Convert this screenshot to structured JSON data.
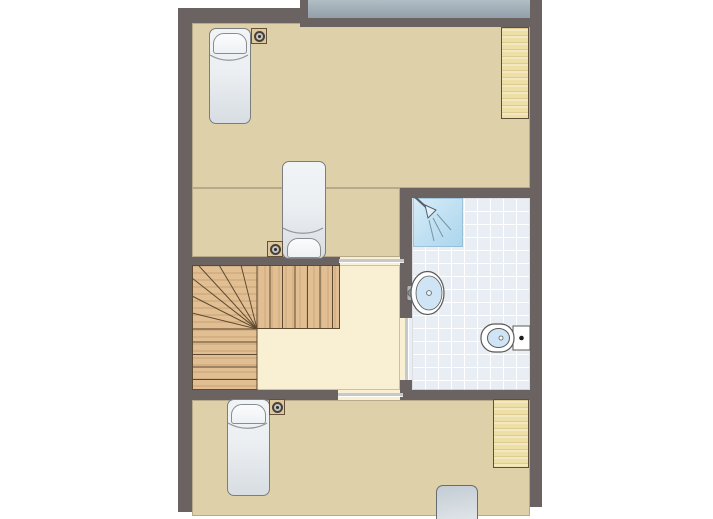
{
  "title": "Floor plan",
  "colors": {
    "wall": "#6b6361",
    "floor-tan": "#ded0a9",
    "floor-cream": "#f9efd3",
    "tile-bg": "#e9edf4",
    "tile-line": "#ffffff",
    "roof-top": "#b2bec6",
    "roof-bottom": "#939fa9",
    "door": "#c6c9cb",
    "wood-stairs": "#e2bf93",
    "stair-line": "#5e4a31",
    "wood-desk": "#eedfa6",
    "desk-line": "#5f5038",
    "bed-top": "#f1f4f6",
    "bed-bottom": "#d7dde2",
    "bed-outline": "#7b7d7f",
    "pillow": "#fbfcfd",
    "bed4-top": "#c3ccd4",
    "bed4-bottom": "#e0e5e9",
    "nightstand": "#dfc99c",
    "nightstand-outline": "#63513a",
    "lamp-ring": "#45413c",
    "shower-top": "#d6ecf8",
    "shower-bottom": "#aad5ec",
    "fixture-outline": "#5a5a58",
    "basin": "#cfe4f4",
    "toilet-dot": "#1c1c1c"
  },
  "plan": {
    "rooms": [
      {
        "id": "bedroom-top",
        "kind": "bedroom"
      },
      {
        "id": "stair-hall",
        "kind": "hallway-with-stairs"
      },
      {
        "id": "bathroom",
        "kind": "bathroom"
      },
      {
        "id": "bedroom-bottom",
        "kind": "bedroom"
      }
    ],
    "furniture": [
      {
        "id": "bed-1",
        "kind": "single-bed",
        "room": "bedroom-top"
      },
      {
        "id": "bed-2",
        "kind": "single-bed",
        "room": "bedroom-top"
      },
      {
        "id": "bed-3",
        "kind": "single-bed",
        "room": "bedroom-bottom"
      },
      {
        "id": "bed-4",
        "kind": "single-bed-partial",
        "room": "bedroom-bottom"
      },
      {
        "id": "nightstand-1",
        "kind": "nightstand-with-lamp",
        "room": "bedroom-top"
      },
      {
        "id": "nightstand-2",
        "kind": "nightstand-with-lamp",
        "room": "bedroom-top"
      },
      {
        "id": "nightstand-3",
        "kind": "nightstand-with-lamp",
        "room": "bedroom-bottom"
      },
      {
        "id": "desk-1",
        "kind": "desk",
        "room": "bedroom-top"
      },
      {
        "id": "desk-2",
        "kind": "desk",
        "room": "bedroom-bottom"
      },
      {
        "id": "staircase",
        "kind": "winder-staircase",
        "room": "stair-hall"
      },
      {
        "id": "shower",
        "kind": "shower",
        "room": "bathroom"
      },
      {
        "id": "washbasin",
        "kind": "washbasin",
        "room": "bathroom"
      },
      {
        "id": "toilet",
        "kind": "toilet",
        "room": "bathroom"
      }
    ],
    "doors": [
      {
        "id": "door-stair-hall-top"
      },
      {
        "id": "door-stair-hall-bottom"
      },
      {
        "id": "door-bathroom"
      }
    ]
  }
}
